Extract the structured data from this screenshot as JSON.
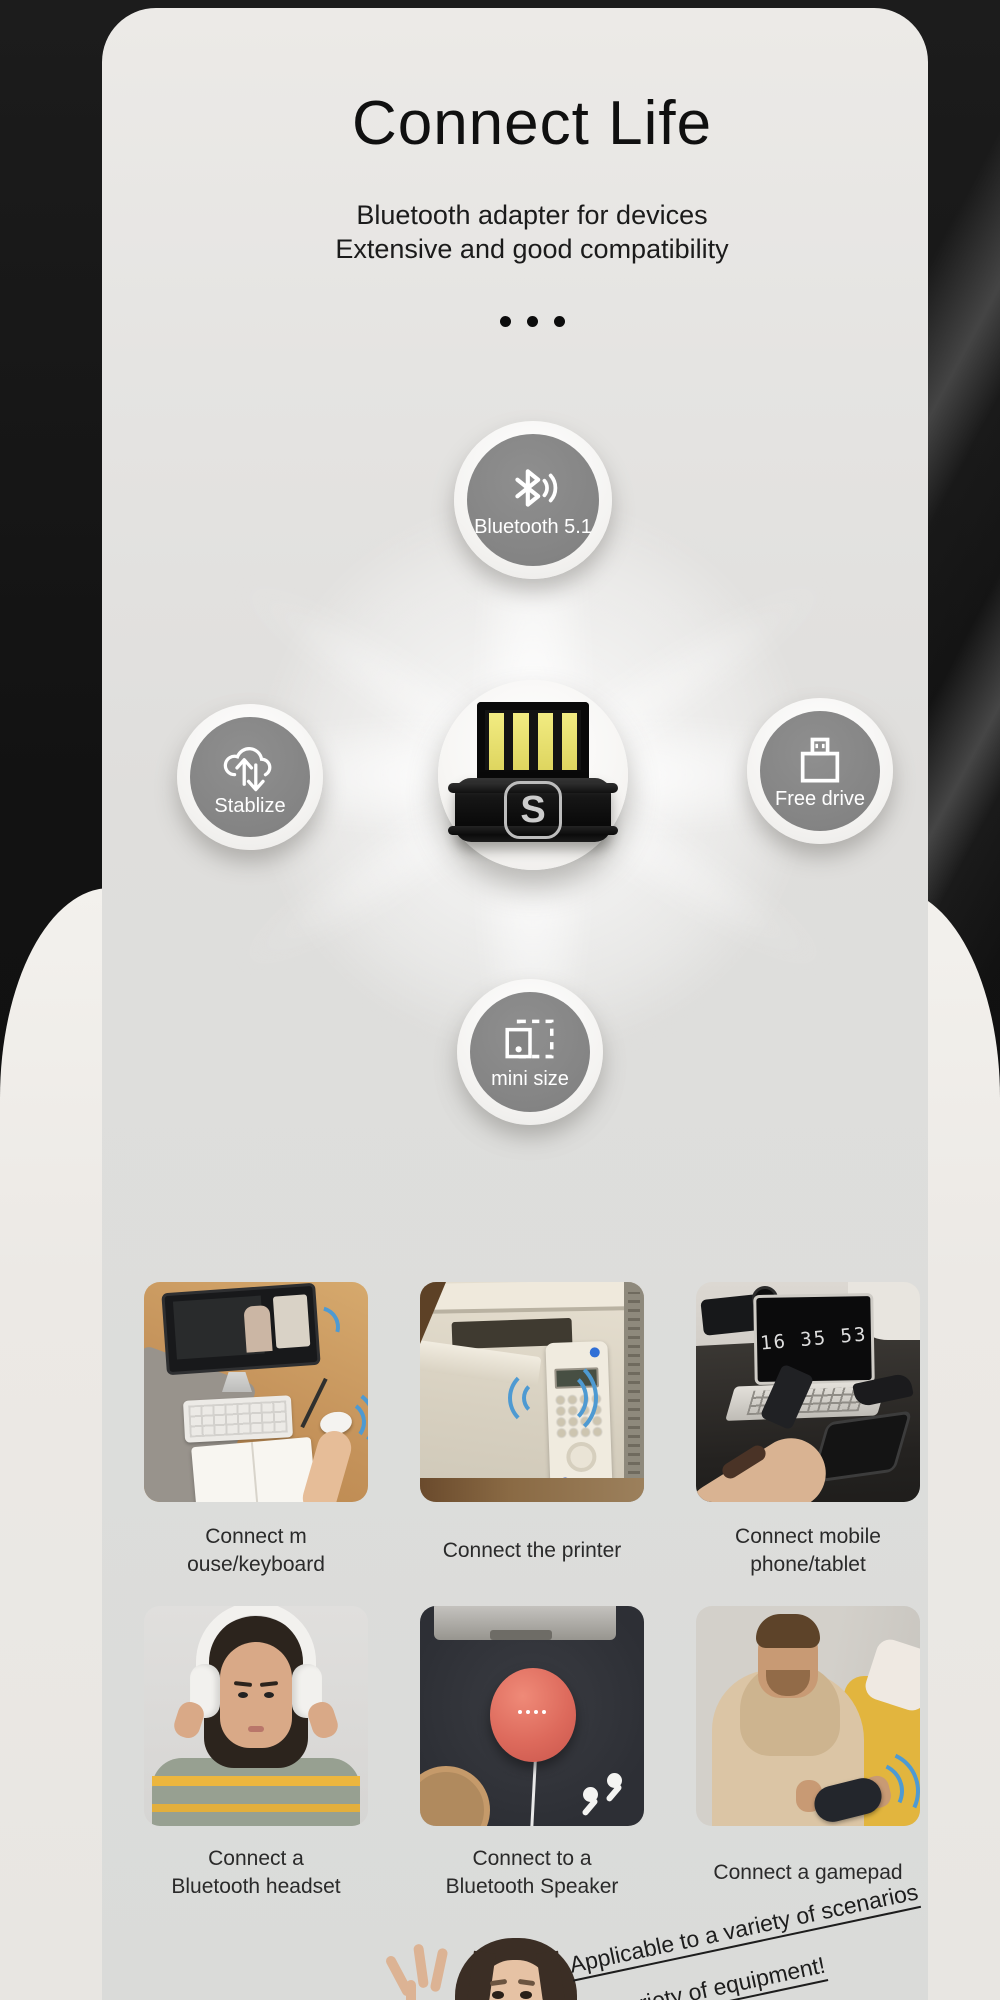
{
  "header": {
    "title": "Connect Life",
    "subtitle_line1": "Bluetooth adapter for devices",
    "subtitle_line2": "Extensive and good compatibility"
  },
  "diagram": {
    "center_logo_letter": "S",
    "badges": {
      "top": {
        "label": "Bluetooth 5.1"
      },
      "left": {
        "label": "Stablize"
      },
      "right": {
        "label": "Free drive"
      },
      "bottom": {
        "label": "mini size"
      }
    }
  },
  "scenarios": [
    {
      "line1": "Connect m",
      "line2": "ouse/keyboard"
    },
    {
      "line1": "Connect the printer",
      "line2": ""
    },
    {
      "line1": "Connect mobile",
      "line2": "phone/tablet"
    },
    {
      "line1": "Connect a",
      "line2": "Bluetooth headset"
    },
    {
      "line1": "Connect to a",
      "line2": "Bluetooth Speaker"
    },
    {
      "line1": "Connect a gamepad",
      "line2": "",
      "overlay_clock": "16 35 53"
    }
  ],
  "clock_display": "16 35 53",
  "footer": {
    "line1": "Applicable to a variety of scenarios",
    "line2": "A variety of equipment!"
  },
  "colors": {
    "background_black": "#121212",
    "card_gray": "#dfdedc",
    "panel_warm_white": "#f0eeea",
    "badge_gray": "#848484",
    "usb_pin_yellow": "#e9e06a",
    "wave_blue": "#4e9ad2",
    "speaker_coral": "#dd6a5c",
    "stripe_yellow": "#ecb63e"
  }
}
